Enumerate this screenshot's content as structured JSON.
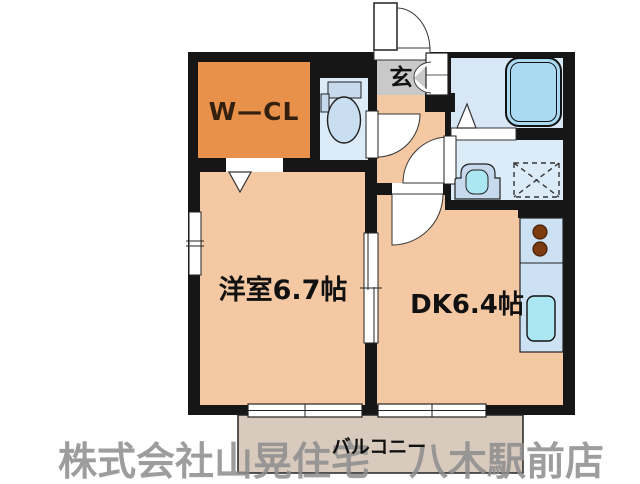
{
  "floor_plan": {
    "rooms": {
      "wcl": {
        "label": "W—CL"
      },
      "genkan": {
        "label": "玄"
      },
      "western_room": {
        "label": "洋室6.7帖"
      },
      "dining_kitchen": {
        "label": "DK6.4帖"
      },
      "balcony": {
        "label": "バルコニー"
      }
    },
    "watermark": "株式会社山晃住宅　八木駅前店",
    "colors": {
      "wall": "#161616",
      "floor": "#f3c8a3",
      "wcl_orange": "#e8914b",
      "genkan_gray": "#c9c9c9",
      "water_blue": "#dcebf8",
      "bath_floor": "#d7e7f5",
      "tub_fill": "#a9daf2",
      "fixture_blue": "#c6d9ed",
      "bowl_blue": "#cadef2",
      "sink_cyan": "#abe7f2",
      "counter_blue": "#cde1f4",
      "burner_brown": "#7b3a10",
      "balcony_fill": "#d8cabd",
      "watermark_gray": "#8d8d8d",
      "line": "#222222",
      "label_dark": "#34200e",
      "text_black": "#111111"
    }
  }
}
